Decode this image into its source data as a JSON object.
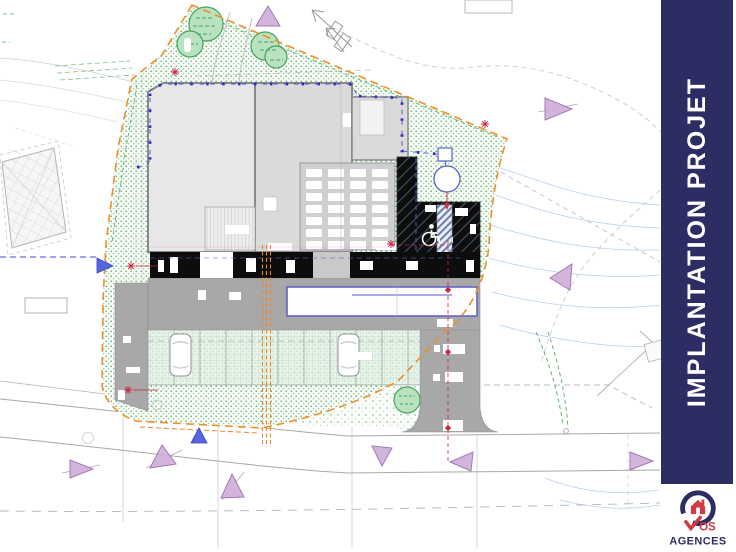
{
  "banner": {
    "title": "IMPLANTATION PROJET"
  },
  "logo": {
    "vos": "VOS",
    "vos_suffix": "OS",
    "agences": "AGENCES"
  },
  "plan": {
    "kind": "architectural-site-plan"
  },
  "icons": {
    "north_arrow": "↖",
    "wheelchair": "♿",
    "survey_cross": "✳",
    "boundary_marker_triangle": "▲",
    "logo_house": "⌂",
    "logo_checkmark": "✓"
  },
  "colors": {
    "banner_navy": "#2c2d62",
    "logo_red": "#d13a45",
    "boundary_orange": "#ef8f2a",
    "setback_blue": "#3a3ac8",
    "survey_red": "#c9253d",
    "marker_purple": "#cfaed9",
    "vegetation_green": "#4aa85c",
    "building_gray": "#d9d9d9",
    "paving_gray": "#a8a8a8",
    "facade_black": "#0d0d0d"
  }
}
